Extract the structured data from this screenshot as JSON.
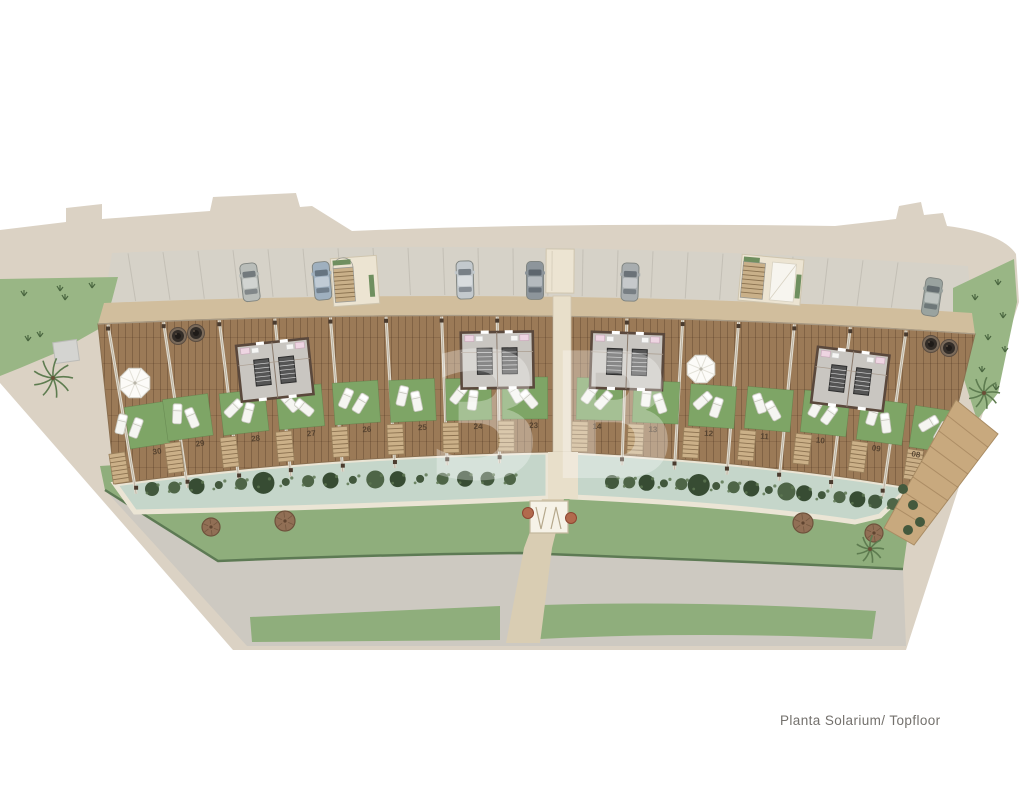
{
  "caption": {
    "text": "Planta Solarium/ Topfloor"
  },
  "plan": {
    "name": "residential-site-plan-solarium-level",
    "unit_numbers": [
      "30",
      "29",
      "28",
      "27",
      "26",
      "25",
      "24",
      "23",
      "14",
      "13",
      "12",
      "11",
      "10",
      "09",
      "08"
    ],
    "watermark_text": "3B"
  },
  "colors": {
    "background": "#ffffff",
    "site_border_beige": "#dbd2c4",
    "parking_gray": "#d6d2c8",
    "walkway_tan": "#d1be9d",
    "deck_wood_brown": "#9b7a57",
    "unit_lawn_green": "#7ea566",
    "lawn_band_green": "#8fae7c",
    "side_lawn_green": "#99b685",
    "pool_water": "#c5d6ca",
    "pool_edge_cream": "#ebe5d5",
    "hedge_dark_green": "#42583d",
    "road_gray": "#cdc9c1",
    "path_cream": "#e8dfca",
    "tree_brown": "#916f55",
    "tree_red": "#b26a4d",
    "caption_text": "#74716d"
  },
  "icons": {
    "car": "car-icon",
    "palm_tree": "palm-tree-icon",
    "umbrella": "umbrella-icon",
    "sun_lounger": "sun-lounger-icon",
    "round_tree": "tree-icon",
    "hedge": "hedge-icon",
    "jacuzzi": "jacuzzi-icon",
    "stairs": "stairs-icon",
    "gate": "gate-icon"
  }
}
